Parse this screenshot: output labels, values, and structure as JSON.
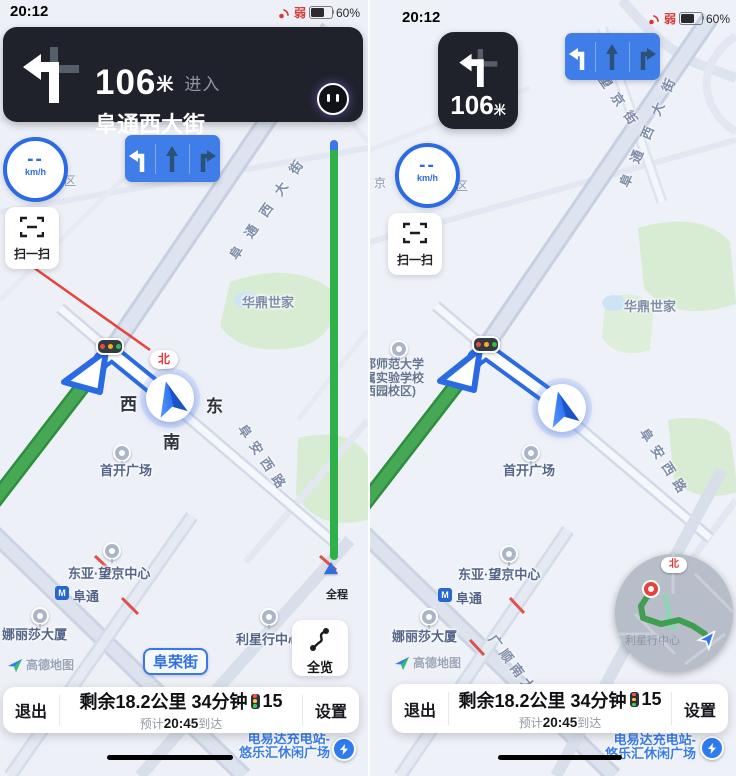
{
  "status": {
    "time": "20:12",
    "weak_label": "弱",
    "battery_percent": "60%"
  },
  "colors": {
    "accent_blue": "#3478f6",
    "lane_blue": "#3f7de8",
    "route_green": "#46a854",
    "banner_dark": "#1f222b",
    "alert_red": "#e03b38"
  },
  "left": {
    "banner": {
      "distance": "106",
      "unit": "米",
      "action": "进入",
      "road": "阜通西大街"
    },
    "speed_value": "--",
    "speed_unit": "km/h",
    "scan_label": "扫一扫",
    "overview_label": "全览",
    "progress_label": "全程",
    "labels": {
      "futong_road": "阜通西大街",
      "fuan_road": "阜安西路",
      "furong_road": "阜荣街",
      "huading": "华鼎世家",
      "compass": "北",
      "west": "西",
      "east": "东",
      "south": "南",
      "shoukai": "首开广场",
      "dongya": "东亚·望京中心",
      "futong_station": "阜通",
      "nalisha": "娜丽莎大厦",
      "lixing": "利星行中心",
      "fragment_qu": "区",
      "watermark": "高德地图",
      "charging1": "电易达充电站-",
      "charging2": "悠乐汇休闲广场"
    },
    "bottom": {
      "exit": "退出",
      "remaining": "剩余18.2公里 34分钟",
      "lights": "15",
      "eta_prefix": "预计",
      "eta_time": "20:45",
      "eta_suffix": "到达",
      "settings": "设置"
    }
  },
  "right": {
    "banner": {
      "distance": "106",
      "unit": "米"
    },
    "speed_value": "--",
    "speed_unit": "km/h",
    "scan_label": "扫一扫",
    "labels": {
      "wangjing_road": "望京街",
      "futong_road": "阜通西大街",
      "fuan_road": "阜安西路",
      "guangshun_road": "广顺南大街",
      "huading": "华鼎世家",
      "school1": "都师范大学",
      "school2": "属实验学校",
      "school3": "西园校区)",
      "shoukai": "首开广场",
      "dongya": "东亚·望京中心",
      "futong_station": "阜通",
      "nalisha": "娜丽莎大厦",
      "fragment_jing": "京",
      "fragment_qu": "区",
      "fragment_jie": "街",
      "watermark": "高德地图",
      "minimap_compass": "北",
      "minimap_poi": "利星行中心",
      "charging1": "电易达充电站-",
      "charging2": "悠乐汇休闲广场"
    },
    "bottom": {
      "exit": "退出",
      "remaining": "剩余18.2公里 34分钟",
      "lights": "15",
      "eta_prefix": "预计",
      "eta_time": "20:45",
      "eta_suffix": "到达",
      "settings": "设置"
    }
  }
}
